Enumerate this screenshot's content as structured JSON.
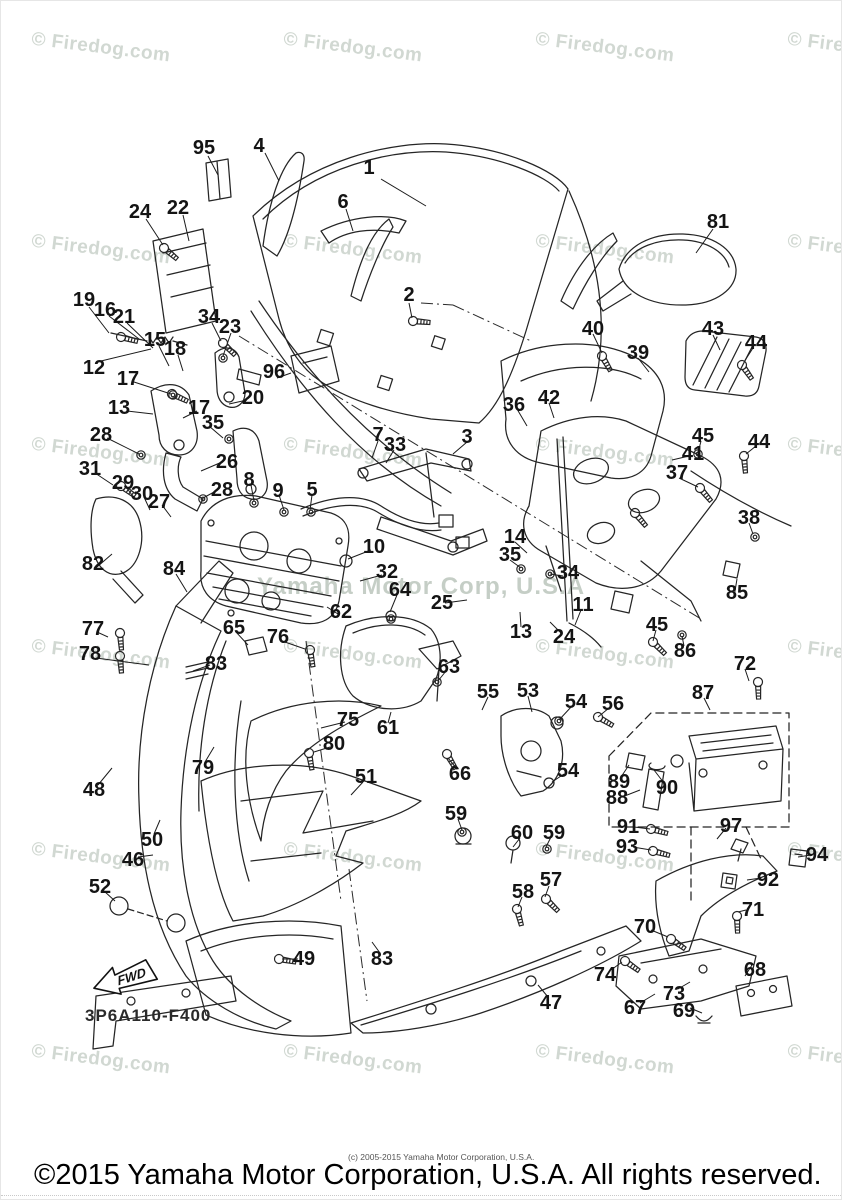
{
  "watermark": {
    "tile_text": "© Firedog.com",
    "center_text": "Yamaha Motor Corp, U.S.A",
    "columns": [
      30,
      282,
      534,
      786
    ],
    "rows": [
      36,
      238,
      441,
      643,
      846,
      1048
    ]
  },
  "diagram": {
    "code": "3P6A110-F400",
    "fwd_label": "FWD"
  },
  "footer": {
    "small_copyright": "(c) 2005-2015 Yamaha Motor Corporation, U.S.A.",
    "copyright": "©2015 Yamaha Motor Corporation, U.S.A. All rights reserved."
  },
  "part_labels": [
    {
      "n": "95",
      "x": 203,
      "y": 147
    },
    {
      "n": "4",
      "x": 258,
      "y": 145
    },
    {
      "n": "1",
      "x": 368,
      "y": 167
    },
    {
      "n": "6",
      "x": 342,
      "y": 201
    },
    {
      "n": "81",
      "x": 717,
      "y": 221
    },
    {
      "n": "24",
      "x": 139,
      "y": 211
    },
    {
      "n": "22",
      "x": 177,
      "y": 207
    },
    {
      "n": "2",
      "x": 408,
      "y": 294
    },
    {
      "n": "19",
      "x": 83,
      "y": 299
    },
    {
      "n": "16",
      "x": 104,
      "y": 309
    },
    {
      "n": "21",
      "x": 123,
      "y": 316
    },
    {
      "n": "34",
      "x": 208,
      "y": 316
    },
    {
      "n": "23",
      "x": 229,
      "y": 326
    },
    {
      "n": "15",
      "x": 154,
      "y": 339
    },
    {
      "n": "18",
      "x": 174,
      "y": 348
    },
    {
      "n": "12",
      "x": 93,
      "y": 367
    },
    {
      "n": "96",
      "x": 273,
      "y": 371
    },
    {
      "n": "40",
      "x": 592,
      "y": 328
    },
    {
      "n": "39",
      "x": 637,
      "y": 352
    },
    {
      "n": "43",
      "x": 712,
      "y": 328
    },
    {
      "n": "44",
      "x": 755,
      "y": 342
    },
    {
      "n": "17",
      "x": 127,
      "y": 378
    },
    {
      "n": "20",
      "x": 252,
      "y": 397
    },
    {
      "n": "13",
      "x": 118,
      "y": 407
    },
    {
      "n": "17",
      "x": 198,
      "y": 407
    },
    {
      "n": "35",
      "x": 212,
      "y": 422
    },
    {
      "n": "28",
      "x": 100,
      "y": 434
    },
    {
      "n": "26",
      "x": 226,
      "y": 461
    },
    {
      "n": "31",
      "x": 89,
      "y": 468
    },
    {
      "n": "29",
      "x": 122,
      "y": 482
    },
    {
      "n": "30",
      "x": 141,
      "y": 493
    },
    {
      "n": "27",
      "x": 158,
      "y": 501
    },
    {
      "n": "28",
      "x": 221,
      "y": 489
    },
    {
      "n": "36",
      "x": 513,
      "y": 404
    },
    {
      "n": "42",
      "x": 548,
      "y": 397
    },
    {
      "n": "3",
      "x": 466,
      "y": 436
    },
    {
      "n": "7",
      "x": 377,
      "y": 434
    },
    {
      "n": "33",
      "x": 394,
      "y": 444
    },
    {
      "n": "41",
      "x": 692,
      "y": 453
    },
    {
      "n": "45",
      "x": 702,
      "y": 435
    },
    {
      "n": "44",
      "x": 758,
      "y": 441
    },
    {
      "n": "37",
      "x": 676,
      "y": 472
    },
    {
      "n": "38",
      "x": 748,
      "y": 517
    },
    {
      "n": "8",
      "x": 248,
      "y": 479
    },
    {
      "n": "9",
      "x": 277,
      "y": 490
    },
    {
      "n": "5",
      "x": 311,
      "y": 489
    },
    {
      "n": "14",
      "x": 514,
      "y": 536
    },
    {
      "n": "35",
      "x": 509,
      "y": 554
    },
    {
      "n": "34",
      "x": 567,
      "y": 572
    },
    {
      "n": "82",
      "x": 92,
      "y": 563
    },
    {
      "n": "84",
      "x": 173,
      "y": 568
    },
    {
      "n": "10",
      "x": 373,
      "y": 546
    },
    {
      "n": "32",
      "x": 386,
      "y": 571
    },
    {
      "n": "64",
      "x": 399,
      "y": 589
    },
    {
      "n": "62",
      "x": 340,
      "y": 611
    },
    {
      "n": "25",
      "x": 441,
      "y": 602
    },
    {
      "n": "11",
      "x": 582,
      "y": 604
    },
    {
      "n": "13",
      "x": 520,
      "y": 631
    },
    {
      "n": "24",
      "x": 563,
      "y": 636
    },
    {
      "n": "85",
      "x": 736,
      "y": 592
    },
    {
      "n": "45",
      "x": 656,
      "y": 624
    },
    {
      "n": "86",
      "x": 684,
      "y": 650
    },
    {
      "n": "72",
      "x": 744,
      "y": 663
    },
    {
      "n": "87",
      "x": 702,
      "y": 692
    },
    {
      "n": "77",
      "x": 92,
      "y": 628
    },
    {
      "n": "78",
      "x": 89,
      "y": 653
    },
    {
      "n": "65",
      "x": 233,
      "y": 627
    },
    {
      "n": "76",
      "x": 277,
      "y": 636
    },
    {
      "n": "83",
      "x": 215,
      "y": 663
    },
    {
      "n": "63",
      "x": 448,
      "y": 666
    },
    {
      "n": "55",
      "x": 487,
      "y": 691
    },
    {
      "n": "53",
      "x": 527,
      "y": 690
    },
    {
      "n": "54",
      "x": 575,
      "y": 701
    },
    {
      "n": "56",
      "x": 612,
      "y": 703
    },
    {
      "n": "75",
      "x": 347,
      "y": 719
    },
    {
      "n": "61",
      "x": 387,
      "y": 727
    },
    {
      "n": "80",
      "x": 333,
      "y": 743
    },
    {
      "n": "66",
      "x": 459,
      "y": 773
    },
    {
      "n": "54",
      "x": 567,
      "y": 770
    },
    {
      "n": "79",
      "x": 202,
      "y": 767
    },
    {
      "n": "48",
      "x": 93,
      "y": 789
    },
    {
      "n": "51",
      "x": 365,
      "y": 776
    },
    {
      "n": "50",
      "x": 151,
      "y": 839
    },
    {
      "n": "46",
      "x": 132,
      "y": 859
    },
    {
      "n": "52",
      "x": 99,
      "y": 886
    },
    {
      "n": "89",
      "x": 618,
      "y": 781
    },
    {
      "n": "88",
      "x": 616,
      "y": 797
    },
    {
      "n": "90",
      "x": 666,
      "y": 787
    },
    {
      "n": "91",
      "x": 627,
      "y": 826
    },
    {
      "n": "97",
      "x": 730,
      "y": 825
    },
    {
      "n": "93",
      "x": 626,
      "y": 846
    },
    {
      "n": "92",
      "x": 767,
      "y": 879
    },
    {
      "n": "94",
      "x": 816,
      "y": 854
    },
    {
      "n": "59",
      "x": 455,
      "y": 813
    },
    {
      "n": "60",
      "x": 521,
      "y": 832
    },
    {
      "n": "59",
      "x": 553,
      "y": 832
    },
    {
      "n": "58",
      "x": 522,
      "y": 891
    },
    {
      "n": "57",
      "x": 550,
      "y": 879
    },
    {
      "n": "49",
      "x": 303,
      "y": 958
    },
    {
      "n": "83",
      "x": 381,
      "y": 958
    },
    {
      "n": "47",
      "x": 550,
      "y": 1002
    },
    {
      "n": "71",
      "x": 752,
      "y": 909
    },
    {
      "n": "70",
      "x": 644,
      "y": 926
    },
    {
      "n": "74",
      "x": 604,
      "y": 974
    },
    {
      "n": "68",
      "x": 754,
      "y": 969
    },
    {
      "n": "73",
      "x": 673,
      "y": 993
    },
    {
      "n": "67",
      "x": 634,
      "y": 1007
    },
    {
      "n": "69",
      "x": 683,
      "y": 1010
    }
  ]
}
